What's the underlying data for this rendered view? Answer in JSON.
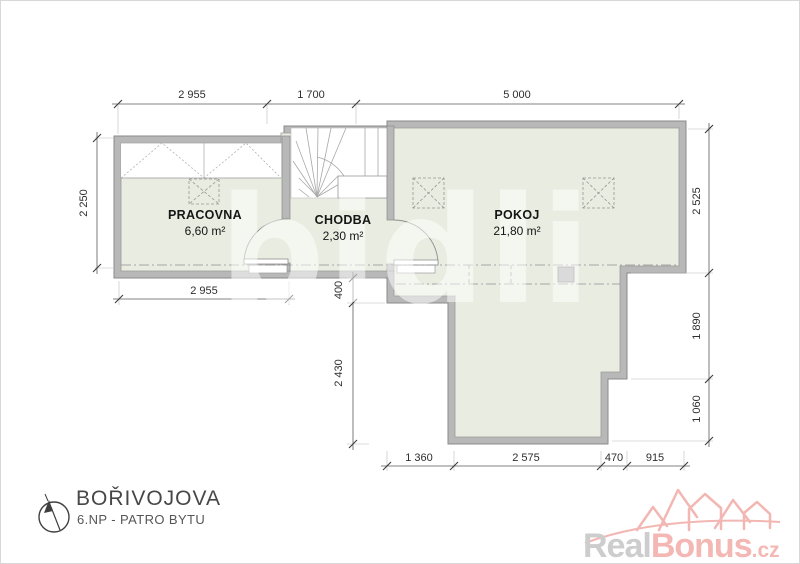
{
  "rooms": [
    {
      "name": "PRACOVNA",
      "area": "6,60 m²"
    },
    {
      "name": "CHODBA",
      "area": "2,30 m²"
    },
    {
      "name": "POKOJ",
      "area": "21,80 m²"
    }
  ],
  "dims": {
    "top_left": "2 955",
    "top_mid": "1 700",
    "top_right": "5 000",
    "left_side": "2 250",
    "below_pracovna": "2 955",
    "step": "400",
    "extension_left": "2 430",
    "right_top": "2 525",
    "right_mid": "1 890",
    "right_bottom": "1 060",
    "bottom_1": "1 360",
    "bottom_2": "2 575",
    "bottom_3": "470",
    "bottom_4": "915"
  },
  "footer": {
    "title": "BOŘIVOJOVA",
    "subtitle": "6.NP - PATRO BYTU"
  },
  "brand": {
    "part_gray": "Real",
    "part_pink": "Bonus",
    "part_tld": ".cz"
  },
  "watermark": "bidli",
  "colors": {
    "floor": "#e9ece0",
    "wall_fill": "#b8b8b8",
    "wall_edge": "#8a8a8a",
    "brand_pink": "#f4b8b4",
    "brand_gray": "#cdcdcd"
  }
}
